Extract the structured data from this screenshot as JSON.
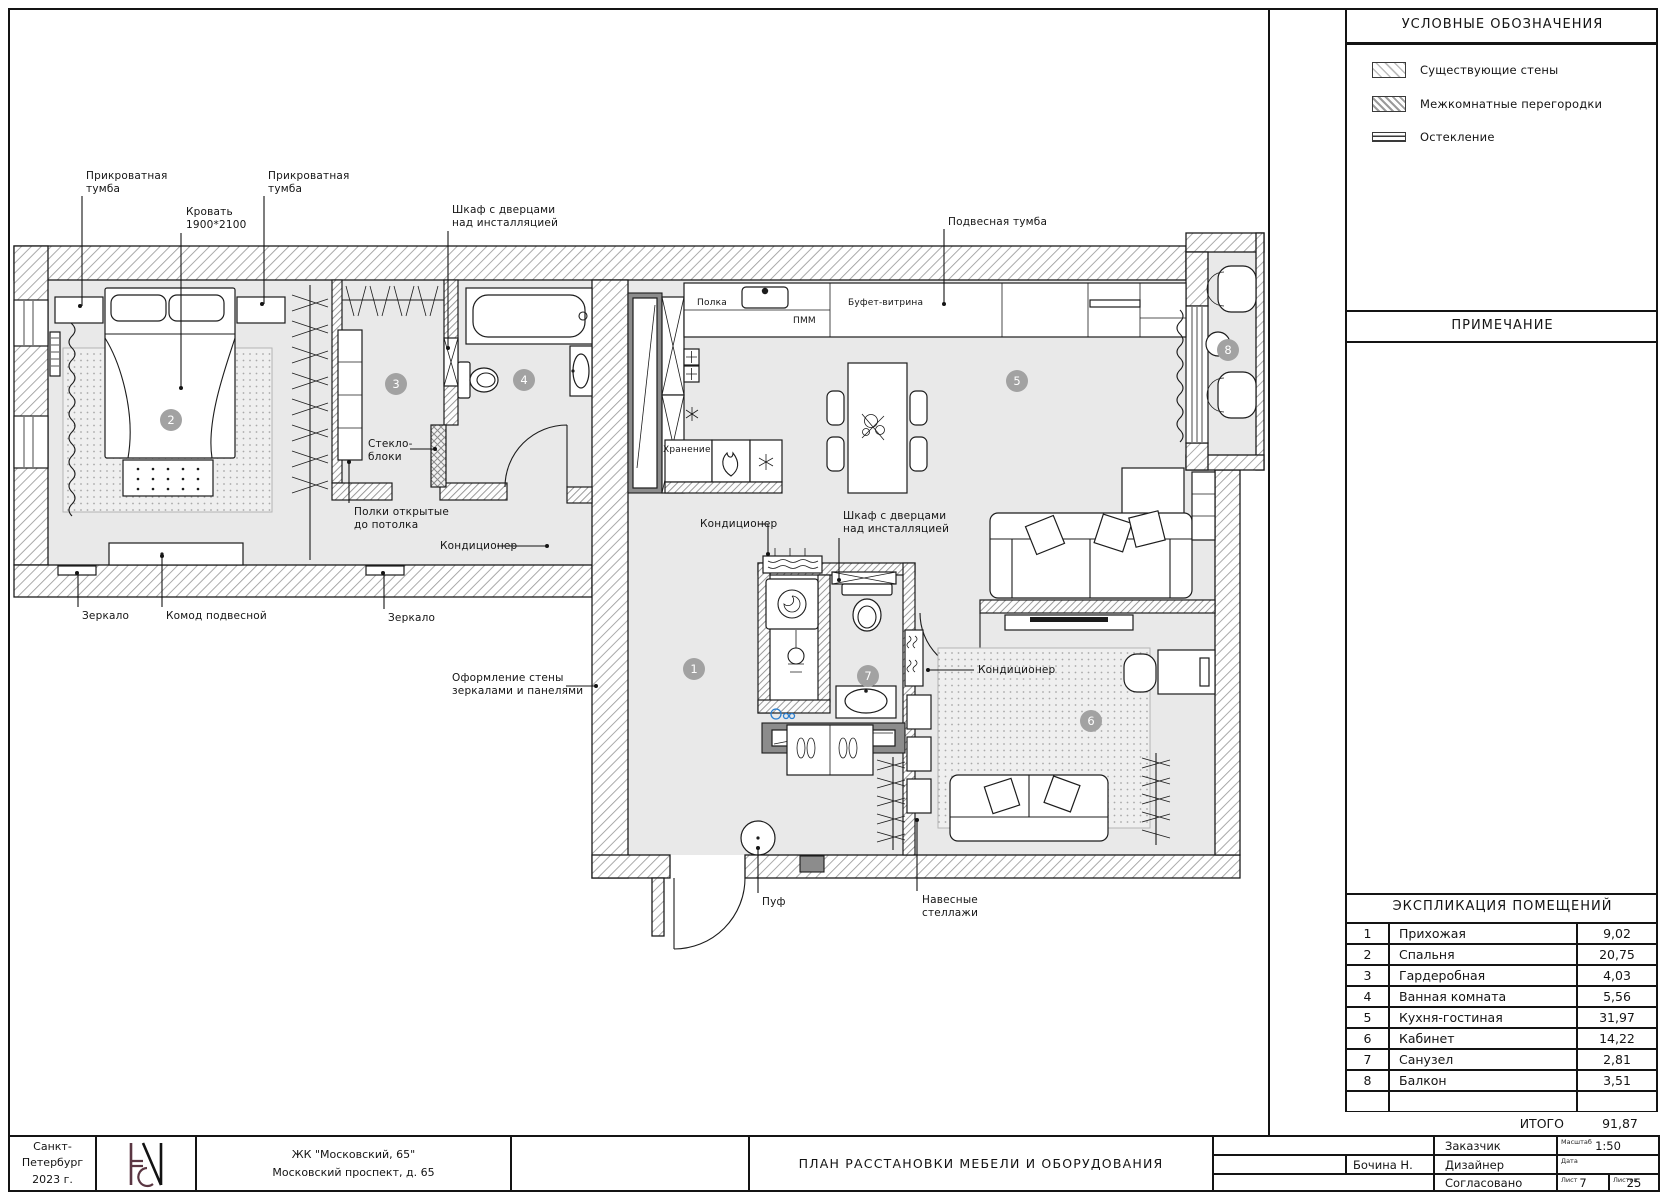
{
  "legend": {
    "title": "УСЛОВНЫЕ ОБОЗНАЧЕНИЯ",
    "items": [
      {
        "label": "Существующие стены",
        "swatch": "hatch-light",
        "icon": "existing-walls-swatch"
      },
      {
        "label": "Межкомнатные перегородки",
        "swatch": "hatch-dense",
        "icon": "partitions-swatch"
      },
      {
        "label": "Остекление",
        "swatch": "glazing",
        "icon": "glazing-swatch"
      }
    ]
  },
  "note": {
    "title": "ПРИМЕЧАНИЕ"
  },
  "schedule": {
    "title": "ЭКСПЛИКАЦИЯ ПОМЕЩЕНИЙ",
    "rows": [
      {
        "num": "1",
        "name": "Прихожая",
        "area": "9,02"
      },
      {
        "num": "2",
        "name": "Спальня",
        "area": "20,75"
      },
      {
        "num": "3",
        "name": "Гардеробная",
        "area": "4,03"
      },
      {
        "num": "4",
        "name": "Ванная комната",
        "area": "5,56"
      },
      {
        "num": "5",
        "name": "Кухня-гостиная",
        "area": "31,97"
      },
      {
        "num": "6",
        "name": "Кабинет",
        "area": "14,22"
      },
      {
        "num": "7",
        "name": "Санузел",
        "area": "2,81"
      },
      {
        "num": "8",
        "name": "Балкон",
        "area": "3,51"
      },
      {
        "num": "",
        "name": "",
        "area": ""
      }
    ],
    "total_label": "ИТОГО",
    "total_value": "91,87"
  },
  "title_block": {
    "city_line1": "Санкт-Петербург",
    "city_line2": "2023 г.",
    "complex_line1": "ЖК \"Московский, 65\"",
    "complex_line2": "Московский проспект, д. 65",
    "drawing_title": "ПЛАН РАССТАНОВКИ МЕБЕЛИ И ОБОРУДОВАНИЯ",
    "customer_label": "Заказчик",
    "designer_name": "Бочина Н.",
    "designer_label": "Дизайнер",
    "approved_label": "Согласовано",
    "scale_label": "Масштаб",
    "scale_value": "1:50",
    "date_label": "Дата",
    "sheet_label": "Лист",
    "sheet_value": "7",
    "sheets_label": "Листов",
    "sheets_value": "25"
  },
  "plan": {
    "room_markers": [
      {
        "num": "1",
        "x": 694,
        "y": 669
      },
      {
        "num": "2",
        "x": 171,
        "y": 420
      },
      {
        "num": "3",
        "x": 396,
        "y": 384
      },
      {
        "num": "4",
        "x": 524,
        "y": 380
      },
      {
        "num": "5",
        "x": 1017,
        "y": 381
      },
      {
        "num": "6",
        "x": 1091,
        "y": 721
      },
      {
        "num": "7",
        "x": 868,
        "y": 676
      },
      {
        "num": "8",
        "x": 1228,
        "y": 350
      }
    ],
    "annotations": [
      {
        "id": "nightstand-left",
        "text": "Прикроватная\nтумба",
        "x": 86,
        "y": 170,
        "leader": [
          [
            82,
            196
          ],
          [
            82,
            306
          ]
        ],
        "dot": [
          80,
          306
        ]
      },
      {
        "id": "nightstand-right",
        "text": "Прикроватная\nтумба",
        "x": 268,
        "y": 170,
        "leader": [
          [
            264,
            196
          ],
          [
            264,
            304
          ]
        ],
        "dot": [
          262,
          304
        ]
      },
      {
        "id": "bed",
        "text": "Кровать\n1900*2100",
        "x": 186,
        "y": 206,
        "leader": [
          [
            181,
            233
          ],
          [
            181,
            388
          ]
        ],
        "dot": [
          181,
          388
        ]
      },
      {
        "id": "cabinet-over-installation-bath",
        "text": "Шкаф с дверцами\nнад инсталляцией",
        "x": 452,
        "y": 204,
        "leader": [
          [
            448,
            231
          ],
          [
            448,
            348
          ]
        ],
        "dot": [
          448,
          348
        ]
      },
      {
        "id": "hanging-cabinet",
        "text": "Подвесная тумба",
        "x": 948,
        "y": 216,
        "leader": [
          [
            944,
            229
          ],
          [
            944,
            304
          ]
        ],
        "dot": [
          944,
          304
        ]
      },
      {
        "id": "glass-blocks",
        "text": "Стекло-\nблоки",
        "x": 368,
        "y": 438,
        "leader": [
          [
            410,
            449
          ],
          [
            433,
            449
          ]
        ],
        "dot": [
          435,
          449
        ]
      },
      {
        "id": "open-shelves",
        "text": "Полки открытые\nдо потолка",
        "x": 354,
        "y": 506,
        "leader": [
          [
            349,
            503
          ],
          [
            349,
            462
          ]
        ],
        "dot": [
          349,
          462
        ]
      },
      {
        "id": "ac-hall",
        "text": "Кондиционер",
        "x": 440,
        "y": 540,
        "leader": [
          [
            497,
            546
          ],
          [
            545,
            546
          ]
        ],
        "dot": [
          547,
          546
        ]
      },
      {
        "id": "mirror-left",
        "text": "Зеркало",
        "x": 82,
        "y": 610,
        "leader": [
          [
            78,
            607
          ],
          [
            78,
            573
          ]
        ],
        "dot": [
          77,
          573
        ]
      },
      {
        "id": "hanging-chest",
        "text": "Комод подвесной",
        "x": 166,
        "y": 610,
        "leader": [
          [
            162,
            607
          ],
          [
            162,
            556
          ]
        ],
        "dot": [
          162,
          556
        ]
      },
      {
        "id": "mirror-right",
        "text": "Зеркало",
        "x": 388,
        "y": 612,
        "leader": [
          [
            384,
            609
          ],
          [
            384,
            573
          ]
        ],
        "dot": [
          383,
          573
        ]
      },
      {
        "id": "wall-decor",
        "text": "Оформление стены\nзеркалами и панелями",
        "x": 452,
        "y": 672,
        "leader": [
          [
            566,
            686
          ],
          [
            594,
            686
          ]
        ],
        "dot": [
          596,
          686
        ]
      },
      {
        "id": "ac-laundry",
        "text": "Кондиционер",
        "x": 700,
        "y": 518,
        "leader": [
          [
            758,
            524
          ],
          [
            768,
            524
          ],
          [
            768,
            552
          ]
        ],
        "dot": [
          768,
          554
        ]
      },
      {
        "id": "cabinet-over-installation-wc",
        "text": "Шкаф с дверцами\nнад инсталляцией",
        "x": 843,
        "y": 510,
        "leader": [
          [
            839,
            538
          ],
          [
            839,
            578
          ]
        ],
        "dot": [
          839,
          580
        ]
      },
      {
        "id": "ac-office",
        "text": "Кондиционер",
        "x": 978,
        "y": 664,
        "leader": [
          [
            974,
            670
          ],
          [
            930,
            670
          ]
        ],
        "dot": [
          928,
          670
        ]
      },
      {
        "id": "pouf",
        "text": "Пуф",
        "x": 762,
        "y": 896,
        "leader": [
          [
            758,
            893
          ],
          [
            758,
            848
          ]
        ],
        "dot": [
          758,
          848
        ]
      },
      {
        "id": "wall-shelving",
        "text": "Навесные\nстеллажи",
        "x": 922,
        "y": 894,
        "leader": [
          [
            917,
            891
          ],
          [
            917,
            820
          ]
        ],
        "dot": [
          917,
          820
        ]
      },
      {
        "id": "shelf-label",
        "text": "Полка",
        "x": 697,
        "y": 298,
        "small": true
      },
      {
        "id": "dishwasher-label",
        "text": "ПММ",
        "x": 793,
        "y": 316,
        "small": true
      },
      {
        "id": "buffet-label",
        "text": "Буфет-витрина",
        "x": 848,
        "y": 298,
        "small": true
      },
      {
        "id": "storage-label",
        "text": "Хранение",
        "x": 663,
        "y": 445,
        "small": true
      }
    ]
  }
}
